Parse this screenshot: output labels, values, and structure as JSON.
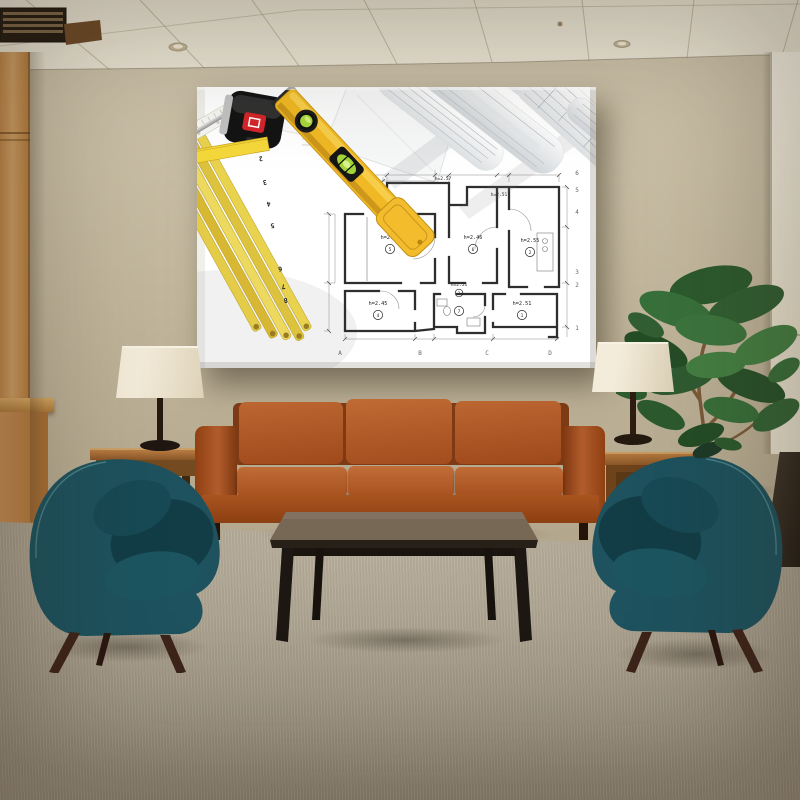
{
  "colors": {
    "wall": "#c7bca3",
    "wall_dark": "#b2a68c",
    "ceiling": "#ece6d6",
    "wood_panel": "#c99355",
    "carpet": "#b6ab96",
    "sofa": "#b1582a",
    "armchair": "#1d525e",
    "coffee_table": "#6b5d4d",
    "side_table": "#8f5e2d",
    "lamp_shade": "#eae1cd",
    "plant_green": "#33602f",
    "canvas_bg": "#ffffff",
    "blueprint_ink": "#2e2e2e",
    "level_yellow": "#efb824",
    "tape_yellow": "#f4d83b",
    "folding_ruler_yellow": "#e8d24e",
    "tape_body_red": "#d3252a",
    "right_panel": "#f4efe1"
  },
  "art": {
    "rooms": [
      {
        "num": "5",
        "h": "h=2.48"
      },
      {
        "num": "6",
        "h": "h=2.46"
      },
      {
        "num": "2",
        "h": "h=2.55"
      },
      {
        "num": "4",
        "h": "h=2.45"
      },
      {
        "num": "7",
        "h": ""
      },
      {
        "num": "1",
        "h": "h=2.51"
      },
      {
        "num": "3",
        "h": "h=2.51"
      }
    ],
    "hall_labels": [
      "h=2.57",
      "h=2.51"
    ],
    "grid_columns": [
      "A",
      "B",
      "C",
      "D"
    ],
    "grid_rows": [
      "1",
      "2",
      "3",
      "4",
      "5",
      "6"
    ],
    "tape_numbers": [
      "2",
      "3",
      "4",
      "5",
      "6",
      "7",
      "8"
    ],
    "tape_mark": "10"
  }
}
